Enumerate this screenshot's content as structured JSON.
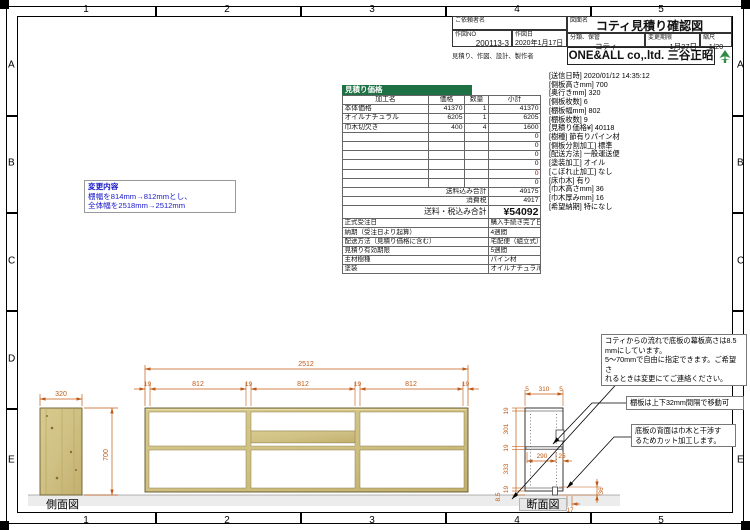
{
  "frame": {
    "cols": [
      "1",
      "2",
      "3",
      "4",
      "5"
    ],
    "rows": [
      "A",
      "B",
      "C",
      "D",
      "E"
    ]
  },
  "title_block": {
    "client_label": "ご依頼者名",
    "drawing_no_label": "作図NO",
    "drawing_no": "200113-3",
    "date_label": "作図日",
    "date": "2020年1月17日",
    "name_label": "図面名",
    "drawing_title": "コティ見積り確認図",
    "category_label": "分類、保管",
    "category": "コティ",
    "change_label": "変更期限",
    "change_date": "1月27日",
    "scale_label": "縮尺",
    "scale": "1/20",
    "maker_label": "見積り、作図、設計、製作者",
    "maker": "ONE&ALL co,.ltd. 三谷正昭"
  },
  "estimate": {
    "band_title": "見積り価格",
    "headers": [
      "加工名",
      "価格",
      "数量",
      "小計"
    ],
    "rows": [
      {
        "name": "本体価格",
        "price": "41370",
        "qty": "1",
        "subtotal": "41370"
      },
      {
        "name": "オイルナチュラル",
        "price": "6205",
        "qty": "1",
        "subtotal": "6205"
      },
      {
        "name": "巾木切欠き",
        "price": "400",
        "qty": "4",
        "subtotal": "1600"
      },
      {
        "name": "",
        "price": "",
        "qty": "",
        "subtotal": "0"
      },
      {
        "name": "",
        "price": "",
        "qty": "",
        "subtotal": "0"
      },
      {
        "name": "",
        "price": "",
        "qty": "",
        "subtotal": "0"
      },
      {
        "name": "",
        "price": "",
        "qty": "",
        "subtotal": "0"
      },
      {
        "name": "",
        "price": "",
        "qty": "",
        "subtotal": "0"
      },
      {
        "name": "",
        "price": "",
        "qty": "",
        "subtotal": "0"
      }
    ],
    "shipping_label": "送料込み合計",
    "shipping_total": "49175",
    "tax_label": "消費税",
    "tax": "4917",
    "grand_label": "送料・税込み合計",
    "grand_total": "¥54092",
    "details": [
      {
        "label": "正式受注日",
        "value": "購入手続き完了日"
      },
      {
        "label": "納期（受注日より起算）",
        "value": "4週間"
      },
      {
        "label": "配送方法（見積り価格に含む）",
        "value": "宅配便（組立式）"
      },
      {
        "label": "見積り有効期限",
        "value": "5週間"
      },
      {
        "label": "主材樹種",
        "value": "パイン材"
      },
      {
        "label": "塗装",
        "value": "オイルナチュラル"
      }
    ]
  },
  "specs": {
    "lines": [
      "[送信日時] 2020/01/12 14:35:12",
      "[側板高さmm] 700",
      "[奥行きmm] 320",
      "[側板枚数] 6",
      "[棚板幅mm] 802",
      "[棚板枚数] 9",
      "[見積り価格¥] 40118",
      "[樹種] 節有りパイン材",
      "[側板分割加工] 標準",
      "[配送方法] 一般運送便",
      "[塗装加工] オイル",
      "[こぼれ止加工] なし",
      "[床巾木] 有り",
      "[巾木高さmm] 36",
      "[巾木厚みmm] 16",
      "[希望納期] 特になし"
    ]
  },
  "change_note": {
    "title": "変更内容",
    "line1": "棚幅を814mm→812mmとし、",
    "line2": "全体幅を2518mm→2512mm"
  },
  "views": {
    "side_label": "側面図",
    "section_label": "断面図"
  },
  "dims": {
    "side_width": "320",
    "side_height": "700",
    "front_total": "2512",
    "front_segs": [
      "19",
      "812",
      "19",
      "812",
      "19",
      "812",
      "19"
    ],
    "sec_top": [
      "5",
      "310",
      "5"
    ],
    "sec_left": [
      "19",
      "301",
      "19",
      "333",
      "19",
      "8.5"
    ],
    "sec_inner": [
      "290",
      "25"
    ],
    "skirt_height": "36",
    "skirt_cut": "17"
  },
  "notes": {
    "n1a": "コティからの流れで底板の幕板高さは8.5",
    "n1b": "mmにしています。",
    "n1c": "5〜70mmで自由に指定できます。ご希望さ",
    "n1d": "れるときは変更にてご連絡ください。",
    "n2": "棚板は上下32mm間隔で移動可",
    "n3a": "底板の背面は巾木と干渉す",
    "n3b": "るためカット加工します。"
  },
  "colors": {
    "dimension": "#c05a14",
    "wood": "#cfc083",
    "band_green": "#1e7145",
    "change_blue": "#1a1acc",
    "zero_red": "#cc0000",
    "logo_green": "#2e8b44"
  }
}
